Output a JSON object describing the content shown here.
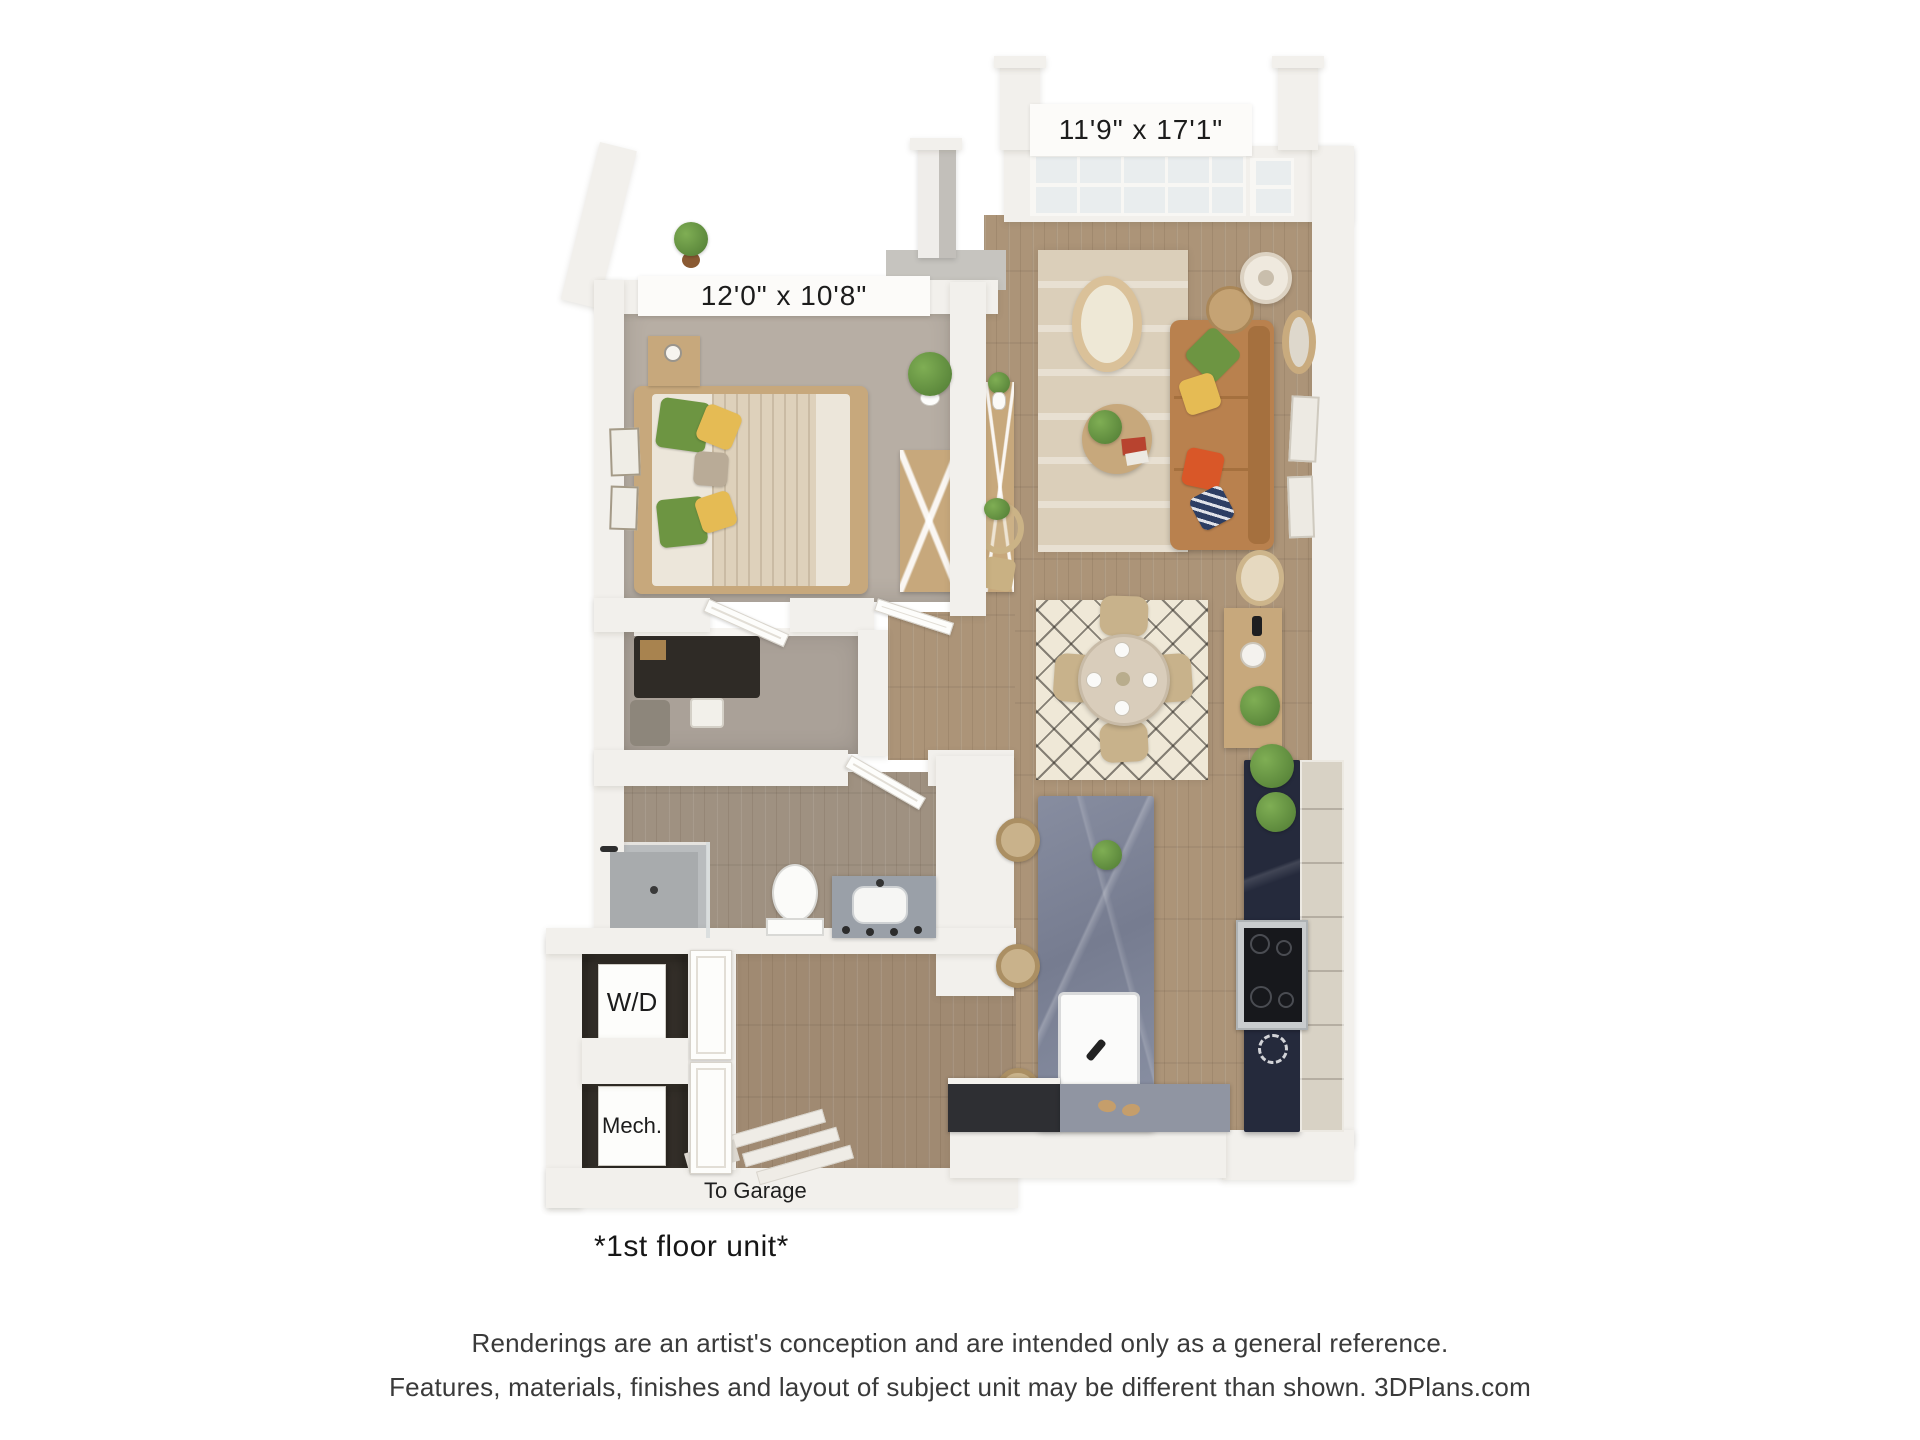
{
  "plan": {
    "labels": {
      "living_dimensions": "11'9\" x 17'1\"",
      "bedroom_dimensions": "12'0\" x 10'8\"",
      "washer_dryer": "W/D",
      "mechanical": "Mech.",
      "to_garage": "To Garage",
      "unit_note": "*1st floor unit*"
    }
  },
  "footer": {
    "disclaimer_line1": "Renderings are an artist's conception and are intended only as a general reference.",
    "disclaimer_line2": "Features, materials, finishes and layout of subject unit may be different than shown. 3DPlans.com"
  },
  "colors": {
    "wall": "#f2f0ec",
    "wood": "#ac9478",
    "carpet": "#b7aea4",
    "glass": "#e9edee",
    "island": "#7e8496",
    "counter_dark": "#252a3c",
    "cabinet": "#d8d2c5",
    "sofa": "#b9814e",
    "rug_living": "#dbcfba",
    "rug_dining": "#efe8d7",
    "wood_furniture": "#c7a87c",
    "green": "#6d9542",
    "yellow": "#e5bb54",
    "orange": "#d95728",
    "navy": "#2d3e63",
    "dark_recess": "#35302a",
    "label_text": "#1c1c1c",
    "disclaimer_text": "#3a3a3a"
  }
}
